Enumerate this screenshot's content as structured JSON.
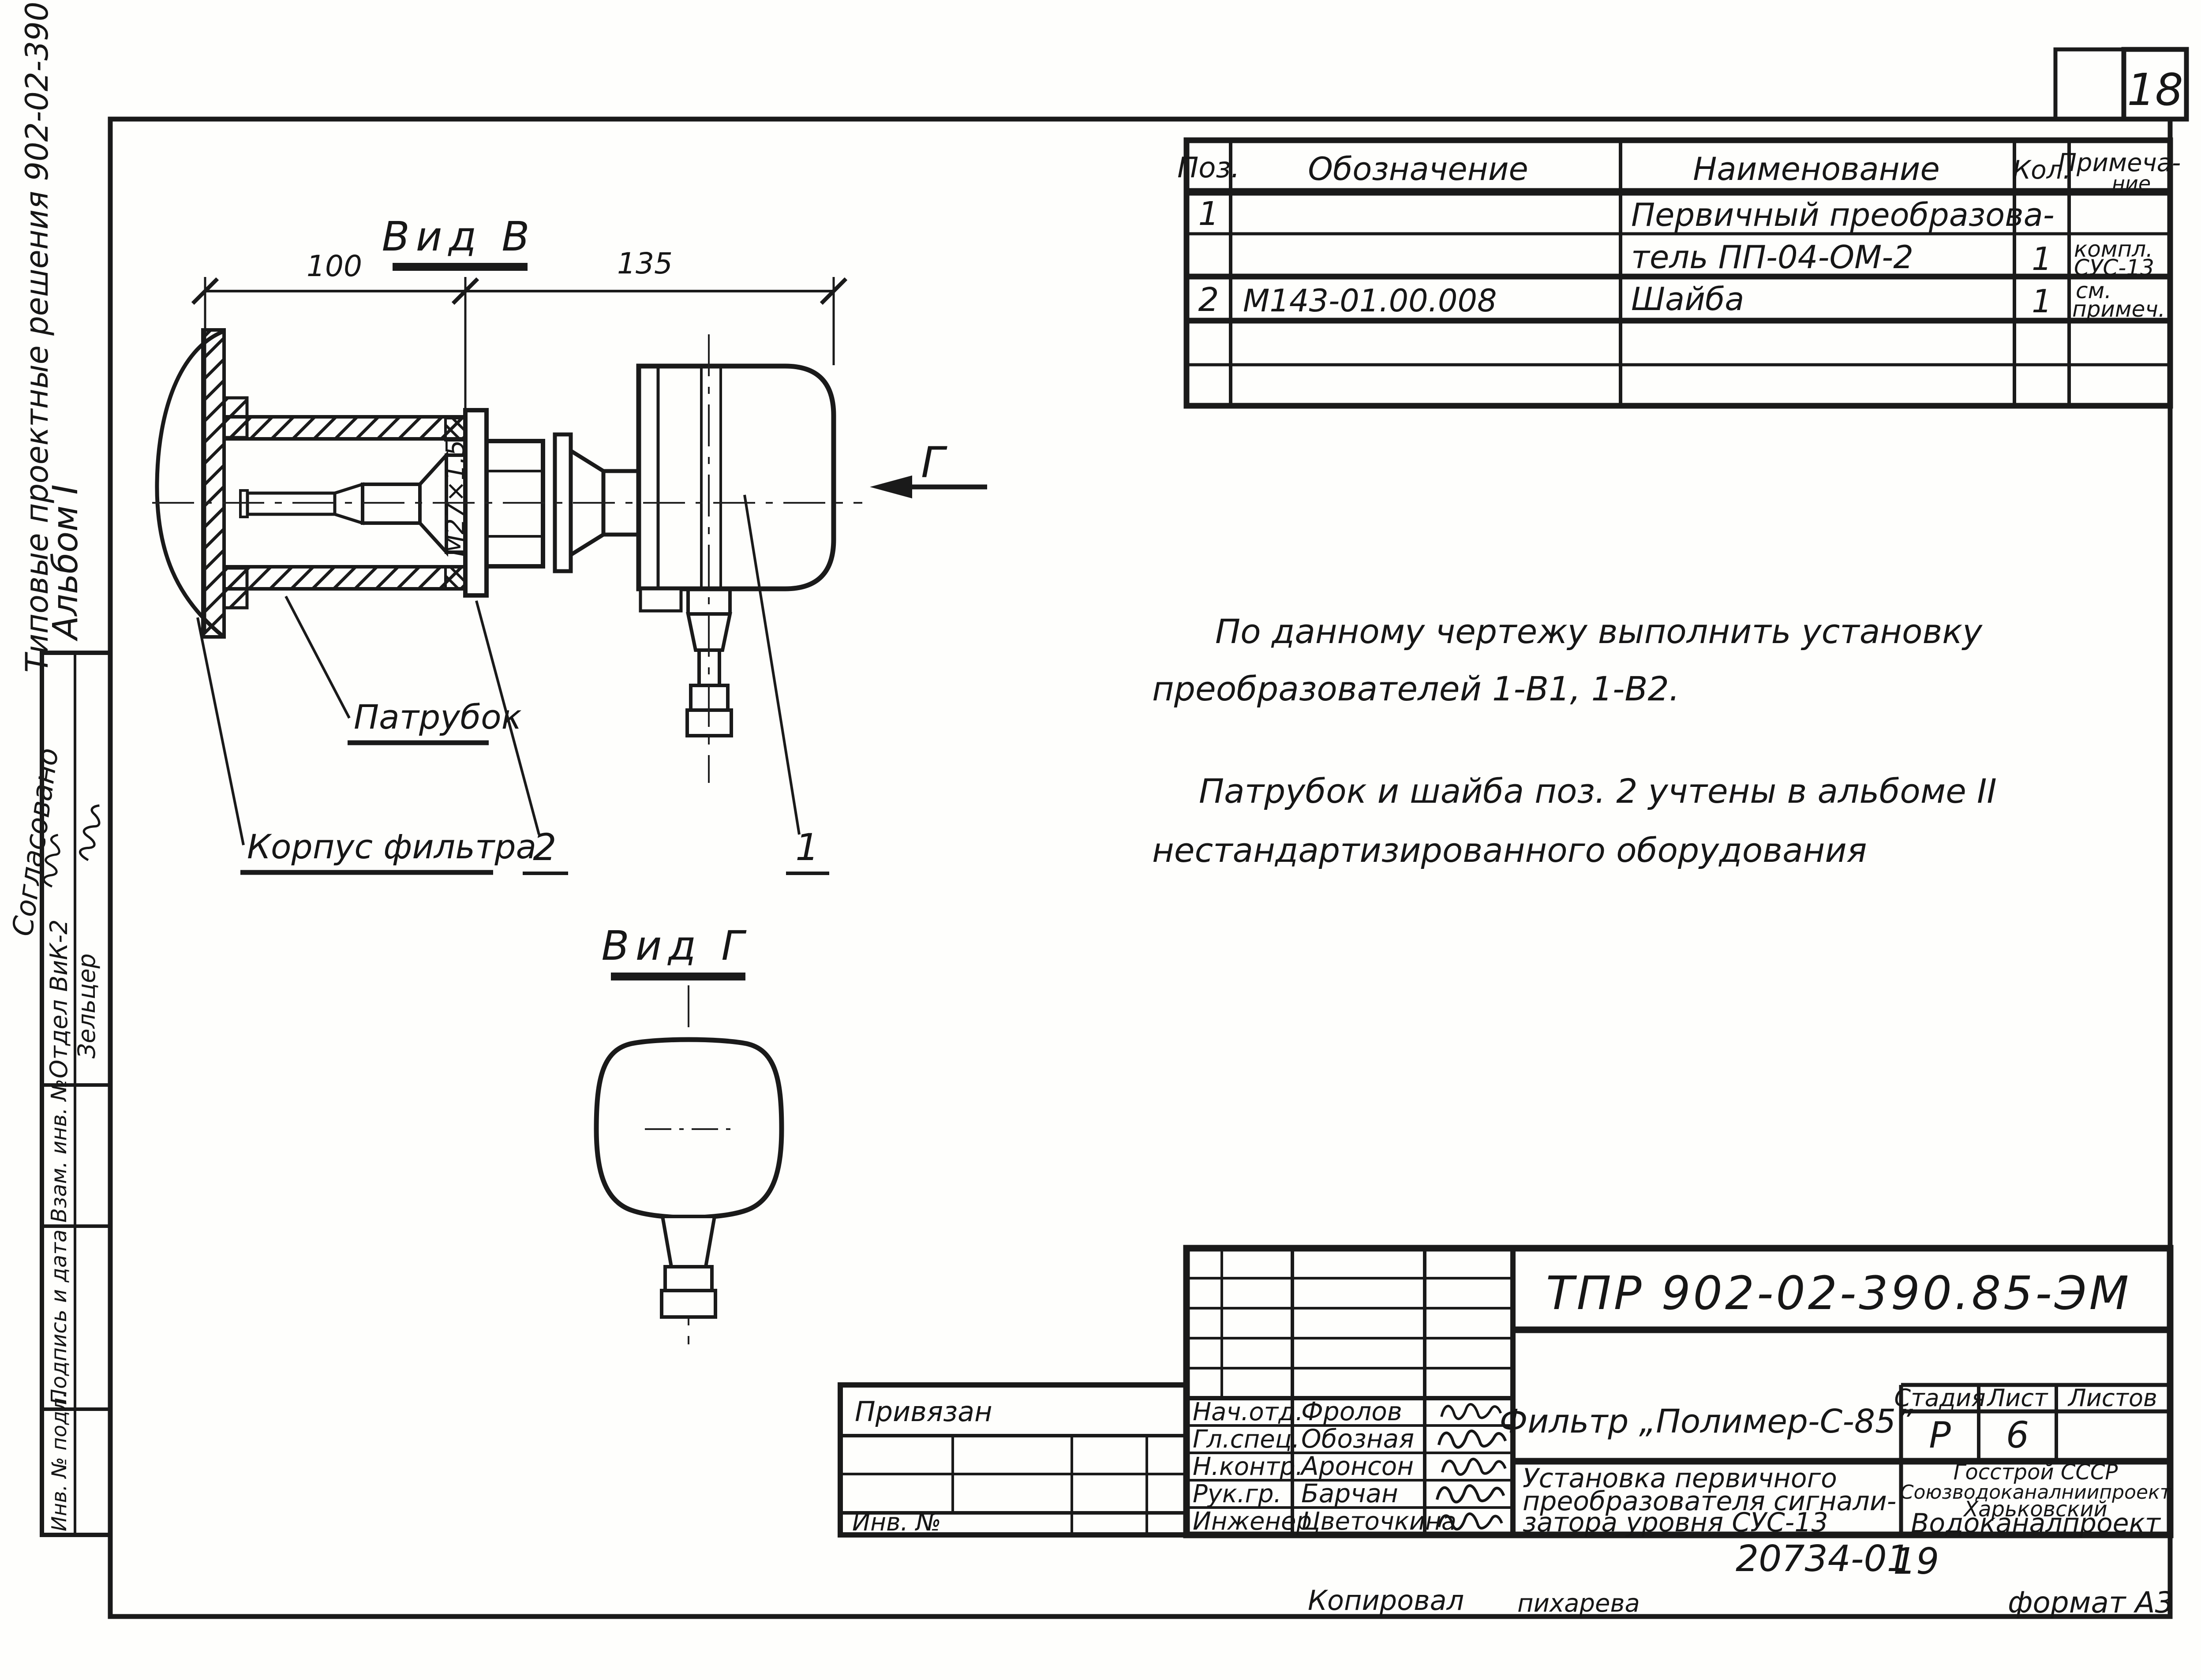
{
  "page": {
    "number": "18"
  },
  "margin": {
    "series_caption": "Типовые проектные решения 902-02-390.85",
    "album": "Альбом I",
    "agreed": "Согласовано",
    "dept_label": "Отдел ВиК-2",
    "dept_name": "Зельцер",
    "replace_inv": "Взам. инв. №",
    "sign_date": "Подпись и дата",
    "inv_orig": "Инв. № подл."
  },
  "parts_table": {
    "headers": {
      "pos": "Поз.",
      "designation": "Обозначение",
      "name": "Наименование",
      "qty": "Кол.",
      "note": [
        "Примеча-",
        "ние"
      ]
    },
    "rows": [
      {
        "pos": "1",
        "designation": "",
        "name": "Первичный преобразова-",
        "qty": "",
        "note": [
          "",
          ""
        ]
      },
      {
        "pos": "",
        "designation": "",
        "name": "тель   ПП-04-ОМ-2",
        "qty": "1",
        "note": [
          "компл.",
          "СУС-13"
        ]
      },
      {
        "pos": "2",
        "designation": "М143-01.00.008",
        "name": "Шайба",
        "qty": "1",
        "note": [
          "см.",
          "примеч."
        ]
      }
    ]
  },
  "view_b": {
    "title": "Вид В",
    "dim_left": "100",
    "dim_right": "135",
    "thread_label": "М27×1,5",
    "pipe_label": "Патрубок",
    "housing_label": "Корпус фильтра",
    "item_1": "1",
    "item_2": "2",
    "view_arrow_label": "Г"
  },
  "view_g": {
    "title": "Вид Г"
  },
  "notes": {
    "line1": "По данному  чертежу   выполнить   установку",
    "line2": "преобразователей     1-В1,   1-В2.",
    "line3": "Патрубок   и   шайба   поз. 2   учтены   в альбоме  II",
    "line4": "нестандартизированного   оборудования"
  },
  "title_block": {
    "doc_number": "ТПР 902-02-390.85-ЭМ",
    "attached_label": "Привязан",
    "inv_label": "Инв. №",
    "staff": [
      {
        "role": "Нач.отд.",
        "name": "Фролов"
      },
      {
        "role": "Гл.спец.",
        "name": "Обозная"
      },
      {
        "role": "Н.контр.",
        "name": "Аронсон"
      },
      {
        "role": "Рук.гр.",
        "name": "Барчан"
      },
      {
        "role": "Инженер",
        "name": "Цветочкина"
      }
    ],
    "project": "Фильтр „Полимер-С-85”",
    "desc": [
      "Установка первичного",
      "преобразователя сигнали-",
      "затора  уровня    СУС-13"
    ],
    "stage_label": "Стадия",
    "sheet_label": "Лист",
    "sheets_label": "Листов",
    "stage": "Р",
    "sheet": "6",
    "sheets": "",
    "org": [
      "Госстрой СССР",
      "Союзводоканалниипроект",
      "Харьковский",
      "Водоканалпроект"
    ]
  },
  "footer": {
    "doc_number": "20734-01",
    "sheet_number": "19",
    "copied_label": "Копировал",
    "copied_by": "пихарева",
    "format_label": "формат А3"
  }
}
